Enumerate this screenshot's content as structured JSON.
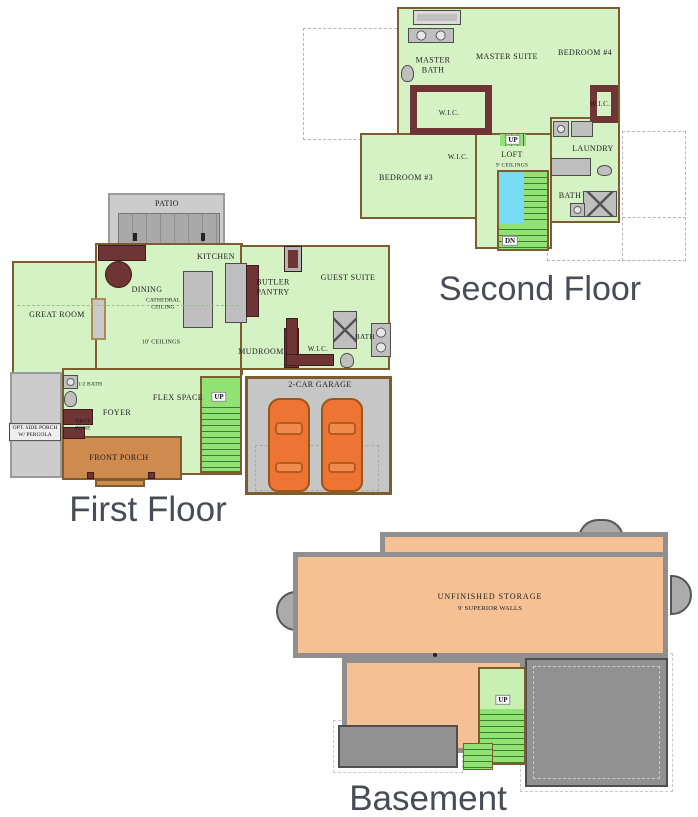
{
  "colors": {
    "room_green": "#d5f2c4",
    "stair_green": "#90e272",
    "stair_light": "#c8f0b0",
    "open_below_blue": "#77dcf3",
    "wall_brown": "#7d5c30",
    "cabinet_maroon": "#6f3434",
    "fixture_gray": "#bfbfbf",
    "concrete_gray": "#cccccc",
    "deck_gray": "#a9a9a9",
    "slab_gray": "#919191",
    "basement_orange": "#f4c094",
    "car_orange": "#ee7433",
    "porch_tan": "#cf8a4e",
    "title_gray": "#474c56",
    "dashed_gray": "#b5b5b5"
  },
  "plans": {
    "second_floor": {
      "title": "Second Floor",
      "labels": {
        "master_bath": "MASTER BATH",
        "master_suite": "MASTER SUITE",
        "bedroom_4": "BEDROOM #4",
        "wic_master": "W.I.C.",
        "wic_bed4": "W.I.C.",
        "wic_bed3": "W.I.C.",
        "bedroom_3": "BEDROOM #3",
        "loft": "LOFT",
        "loft_ceiling": "9' CEILINGS",
        "laundry": "LAUNDRY",
        "bath": "BATH",
        "up": "UP",
        "dn": "DN"
      }
    },
    "first_floor": {
      "title": "First Floor",
      "labels": {
        "patio": "PATIO",
        "kitchen": "KITCHEN",
        "dining": "DINING",
        "cathedral": "CATHEDRAL CEILING",
        "great_room": "GREAT ROOM",
        "ceilings": "10' CEILINGS",
        "butler_pantry": "BUTLER PANTRY",
        "guest_suite": "GUEST SUITE",
        "mudroom": "MUDROOM",
        "wic": "W.I.C.",
        "bath": "BATH",
        "half_bath": "1/2 BATH",
        "foyer": "FOYER",
        "drop_zone": "DROP ZONE",
        "flex_space": "FLEX SPACE",
        "side_porch": "OPT. SIDE PORCH W/ PERGOLA",
        "front_porch": "FRONT PORCH",
        "garage": "2-CAR GARAGE",
        "up": "UP"
      }
    },
    "basement": {
      "title": "Basement",
      "labels": {
        "storage": "UNFINISHED STORAGE",
        "walls": "9' SUPERIOR WALLS",
        "up": "UP"
      }
    }
  }
}
